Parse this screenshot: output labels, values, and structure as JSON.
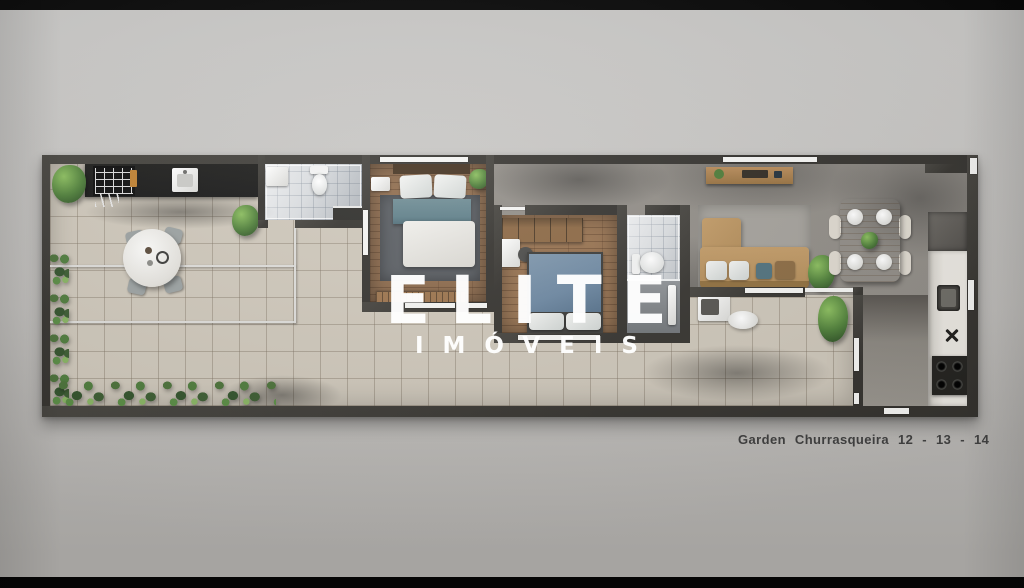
{
  "watermark": {
    "line1": "ELITE",
    "line2": "IMÓVEIS",
    "color": "#ffffff"
  },
  "caption": {
    "text": "Garden Churrasqueira 12 - 13 - 14",
    "color": "#3e3e3e"
  },
  "palette": {
    "letterbox": "#060606",
    "background_top": "#c9c8c6",
    "background_bottom": "#b0aeab",
    "wall": "#34322e",
    "terrace_tile": "#cdc6b9",
    "wood_floor": "#8d6a4b",
    "living_floor": "#8f8b85",
    "bath_tile": "#d9dcdf",
    "hedge_green": "#3c5c33",
    "plant_green": "#5d8f41",
    "sofa_tan": "#b18b58",
    "bed_teal": "#5e7e88",
    "bed_blue": "#6b86a0",
    "dining_wood": "#a97f52",
    "counter_black": "#161616",
    "kitchen_counter": "#e9e6e0",
    "watermark": "#ffffff",
    "caption_text": "#3e3e3e"
  }
}
